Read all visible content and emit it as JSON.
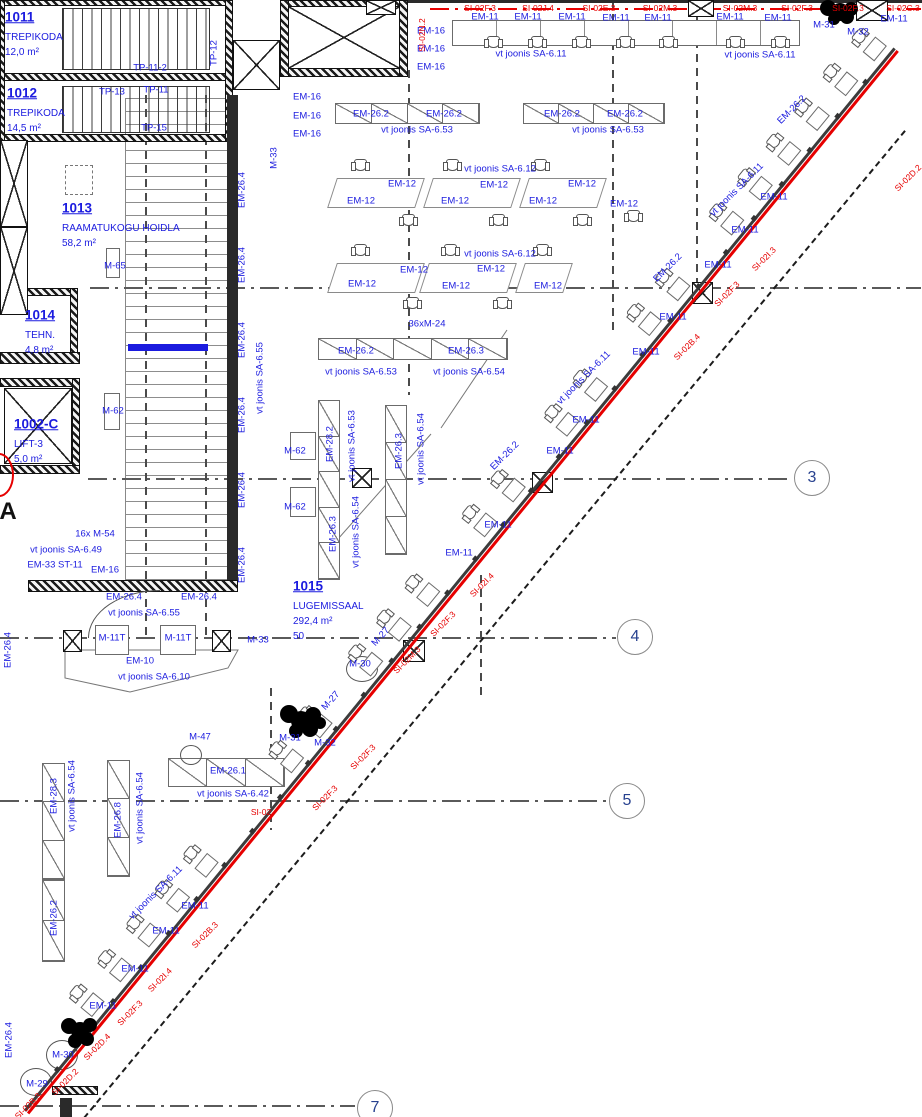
{
  "drawing": {
    "kind": "architectural-floor-plan",
    "language": "Estonian"
  },
  "colors": {
    "annotation_blue": "#1b1bdf",
    "marking_red": "#e60000",
    "grid_bubble_text": "#27418f"
  },
  "rooms": [
    {
      "id": "1011",
      "name": "TREPIKODA",
      "area": "12,0 m²",
      "x": 5,
      "y": 17
    },
    {
      "id": "1012",
      "name": "TREPIKODA",
      "area": "14,5 m²",
      "x": 7,
      "y": 93
    },
    {
      "id": "1013",
      "name": "RAAMATUKOGU HOIDLA",
      "area": "58,2 m²",
      "x": 62,
      "y": 208
    },
    {
      "id": "1014",
      "name": "TEHN.",
      "area": "4,8 m²",
      "x": 25,
      "y": 315
    },
    {
      "id": "1002-C",
      "name": "LIFT-3",
      "area": "5,0 m²",
      "x": 14,
      "y": 424
    },
    {
      "id": "1015",
      "name": "LUGEMISSAAL",
      "area": "292,4 m²",
      "extra": "50",
      "x": 293,
      "y": 586
    }
  ],
  "grid_bubbles": [
    {
      "n": "3",
      "x": 812,
      "y": 478
    },
    {
      "n": "4",
      "x": 635,
      "y": 637
    },
    {
      "n": "5",
      "x": 627,
      "y": 801
    },
    {
      "n": "7",
      "x": 375,
      "y": 1108
    }
  ],
  "grid_letters": [
    {
      "t": "A",
      "x": 8,
      "y": 512
    }
  ],
  "annotations": [
    {
      "t": "TP-11-2",
      "x": 150,
      "y": 68
    },
    {
      "t": "TP-13",
      "x": 112,
      "y": 92
    },
    {
      "t": "TP-11",
      "x": 156,
      "y": 90
    },
    {
      "t": "TP-15",
      "x": 154,
      "y": 128
    },
    {
      "t": "TP-12",
      "x": 214,
      "y": 53,
      "r": -90
    },
    {
      "t": "M-33",
      "x": 274,
      "y": 158,
      "r": -90
    },
    {
      "t": "EM-16",
      "x": 431,
      "y": 31
    },
    {
      "t": "EM-16",
      "x": 431,
      "y": 49
    },
    {
      "t": "EM-16",
      "x": 431,
      "y": 67
    },
    {
      "t": "EM-16",
      "x": 307,
      "y": 97
    },
    {
      "t": "EM-16",
      "x": 307,
      "y": 116
    },
    {
      "t": "EM-16",
      "x": 307,
      "y": 134
    },
    {
      "t": "EM-11",
      "x": 485,
      "y": 17
    },
    {
      "t": "EM-11",
      "x": 528,
      "y": 17
    },
    {
      "t": "EM-11",
      "x": 572,
      "y": 17
    },
    {
      "t": "EM-11",
      "x": 616,
      "y": 18
    },
    {
      "t": "EM-11",
      "x": 658,
      "y": 18
    },
    {
      "t": "EM-11",
      "x": 730,
      "y": 17
    },
    {
      "t": "EM-11",
      "x": 778,
      "y": 18
    },
    {
      "t": "EM-11",
      "x": 894,
      "y": 19
    },
    {
      "t": "vt joonis SA-6.11",
      "x": 531,
      "y": 54
    },
    {
      "t": "vt joonis SA-6.11",
      "x": 760,
      "y": 55
    },
    {
      "t": "M-31",
      "x": 824,
      "y": 25
    },
    {
      "t": "M-32",
      "x": 858,
      "y": 32
    },
    {
      "t": "EM-26.2",
      "x": 371,
      "y": 114
    },
    {
      "t": "EM-26.2",
      "x": 444,
      "y": 114
    },
    {
      "t": "EM-26.2",
      "x": 562,
      "y": 114
    },
    {
      "t": "EM-26.2",
      "x": 625,
      "y": 114
    },
    {
      "t": "vt joonis SA-6.53",
      "x": 417,
      "y": 130
    },
    {
      "t": "vt joonis SA-6.53",
      "x": 608,
      "y": 130
    },
    {
      "t": "vt joonis SA-6.12",
      "x": 500,
      "y": 169
    },
    {
      "t": "vt joonis SA-6.12",
      "x": 500,
      "y": 254
    },
    {
      "t": "EM-12",
      "x": 361,
      "y": 201
    },
    {
      "t": "EM-12",
      "x": 402,
      "y": 184
    },
    {
      "t": "EM-12",
      "x": 455,
      "y": 201
    },
    {
      "t": "EM-12",
      "x": 494,
      "y": 185
    },
    {
      "t": "EM-12",
      "x": 543,
      "y": 201
    },
    {
      "t": "EM-12",
      "x": 582,
      "y": 184
    },
    {
      "t": "EM-12",
      "x": 624,
      "y": 204
    },
    {
      "t": "EM-12",
      "x": 362,
      "y": 284
    },
    {
      "t": "EM-12",
      "x": 414,
      "y": 270
    },
    {
      "t": "EM-12",
      "x": 456,
      "y": 286
    },
    {
      "t": "EM-12",
      "x": 491,
      "y": 269
    },
    {
      "t": "EM-12",
      "x": 548,
      "y": 286
    },
    {
      "t": "36xM-24",
      "x": 427,
      "y": 324
    },
    {
      "t": "EM-26.2",
      "x": 356,
      "y": 351
    },
    {
      "t": "EM-26.3",
      "x": 466,
      "y": 351
    },
    {
      "t": "vt joonis SA-6.53",
      "x": 361,
      "y": 372
    },
    {
      "t": "vt joonis SA-6.54",
      "x": 469,
      "y": 372
    },
    {
      "t": "M-65",
      "x": 115,
      "y": 266
    },
    {
      "t": "M-62",
      "x": 113,
      "y": 411
    },
    {
      "t": "M-62",
      "x": 295,
      "y": 451
    },
    {
      "t": "M-62",
      "x": 295,
      "y": 507
    },
    {
      "t": "EM-28.2",
      "x": 330,
      "y": 444,
      "r": -90
    },
    {
      "t": "vt joonis SA-6.53",
      "x": 352,
      "y": 446,
      "r": -90
    },
    {
      "t": "EM-26.3",
      "x": 333,
      "y": 534,
      "r": -90
    },
    {
      "t": "vt joonis SA-6.54",
      "x": 356,
      "y": 532,
      "r": -90
    },
    {
      "t": "EM-26.3",
      "x": 399,
      "y": 451,
      "r": -90
    },
    {
      "t": "vt joonis SA-6.54",
      "x": 421,
      "y": 449,
      "r": -90
    },
    {
      "t": "EM-26.4",
      "x": 242,
      "y": 190,
      "r": -90
    },
    {
      "t": "EM-26.4",
      "x": 242,
      "y": 265,
      "r": -90
    },
    {
      "t": "EM-26.4",
      "x": 242,
      "y": 340,
      "r": -90
    },
    {
      "t": "EM-26.4",
      "x": 242,
      "y": 415,
      "r": -90
    },
    {
      "t": "EM-26.4",
      "x": 242,
      "y": 490,
      "r": -90
    },
    {
      "t": "EM-26.4",
      "x": 242,
      "y": 565,
      "r": -90
    },
    {
      "t": "vt joonis SA-6.55",
      "x": 260,
      "y": 378,
      "r": -90
    },
    {
      "t": "16x M-54",
      "x": 95,
      "y": 534
    },
    {
      "t": "vt joonis SA-6.49",
      "x": 66,
      "y": 550
    },
    {
      "t": "EM-33 ST-11",
      "x": 55,
      "y": 565
    },
    {
      "t": "EM-16",
      "x": 105,
      "y": 570
    },
    {
      "t": "EM-26.4",
      "x": 124,
      "y": 597
    },
    {
      "t": "EM-26.4",
      "x": 199,
      "y": 597
    },
    {
      "t": "vt joonis SA-6.55",
      "x": 144,
      "y": 613
    },
    {
      "t": "M-11T",
      "x": 112,
      "y": 638
    },
    {
      "t": "M-11T",
      "x": 178,
      "y": 638
    },
    {
      "t": "M-33",
      "x": 258,
      "y": 640
    },
    {
      "t": "EM-10",
      "x": 140,
      "y": 661
    },
    {
      "t": "vt joonis SA-6.10",
      "x": 154,
      "y": 677
    },
    {
      "t": "M-27",
      "x": 381,
      "y": 637,
      "r": -48
    },
    {
      "t": "M-27",
      "x": 331,
      "y": 701,
      "r": -48
    },
    {
      "t": "M-30",
      "x": 360,
      "y": 664
    },
    {
      "t": "M-47",
      "x": 200,
      "y": 737
    },
    {
      "t": "M-31",
      "x": 290,
      "y": 738
    },
    {
      "t": "M-32",
      "x": 325,
      "y": 743
    },
    {
      "t": "EM-26.1",
      "x": 228,
      "y": 771
    },
    {
      "t": "vt joonis SA-6.42",
      "x": 233,
      "y": 794
    },
    {
      "t": "EM-11",
      "x": 774,
      "y": 197
    },
    {
      "t": "EM-11",
      "x": 745,
      "y": 230
    },
    {
      "t": "EM-11",
      "x": 718,
      "y": 265
    },
    {
      "t": "EM-11",
      "x": 673,
      "y": 317
    },
    {
      "t": "EM-11",
      "x": 646,
      "y": 352
    },
    {
      "t": "EM-11",
      "x": 586,
      "y": 420
    },
    {
      "t": "EM-11",
      "x": 560,
      "y": 451
    },
    {
      "t": "EM-11",
      "x": 498,
      "y": 525
    },
    {
      "t": "EM-11",
      "x": 459,
      "y": 553
    },
    {
      "t": "EM-26.2",
      "x": 792,
      "y": 110,
      "r": -45
    },
    {
      "t": "EM-26.2",
      "x": 668,
      "y": 268,
      "r": -45
    },
    {
      "t": "EM-26.2",
      "x": 505,
      "y": 456,
      "r": -45
    },
    {
      "t": "vt joonis SA-6.11",
      "x": 737,
      "y": 190,
      "r": -45
    },
    {
      "t": "vt joonis SA-6.11",
      "x": 584,
      "y": 378,
      "r": -45
    },
    {
      "t": "vt joonis SA-6.11",
      "x": 156,
      "y": 893,
      "r": -45
    },
    {
      "t": "EM-11",
      "x": 195,
      "y": 906
    },
    {
      "t": "EM-11",
      "x": 166,
      "y": 931
    },
    {
      "t": "EM-11",
      "x": 135,
      "y": 969
    },
    {
      "t": "EM-11",
      "x": 103,
      "y": 1006
    },
    {
      "t": "M-30",
      "x": 63,
      "y": 1055
    },
    {
      "t": "M-29",
      "x": 37,
      "y": 1084
    },
    {
      "t": "EM-28.3",
      "x": 54,
      "y": 796,
      "r": -90
    },
    {
      "t": "vt joonis SA-6.54",
      "x": 72,
      "y": 796,
      "r": -90
    },
    {
      "t": "EM-26.8",
      "x": 118,
      "y": 820,
      "r": -90
    },
    {
      "t": "vt joonis SA-6.54",
      "x": 140,
      "y": 808,
      "r": -90
    },
    {
      "t": "EM-26.2",
      "x": 54,
      "y": 918,
      "r": -90
    },
    {
      "t": "EM-26.4",
      "x": 8,
      "y": 650,
      "r": -90
    },
    {
      "t": "EM-26.4",
      "x": 9,
      "y": 1040,
      "r": -90
    }
  ],
  "red_labels": [
    {
      "t": "SI-02N.2",
      "x": 422,
      "y": 35,
      "r": -90
    },
    {
      "t": "SI-02F.3",
      "x": 480,
      "y": 8
    },
    {
      "t": "SI-02J.4",
      "x": 538,
      "y": 8
    },
    {
      "t": "SI-02E.3",
      "x": 599,
      "y": 8
    },
    {
      "t": "SI-02M.3",
      "x": 660,
      "y": 8
    },
    {
      "t": "SI-02M.3",
      "x": 740,
      "y": 8
    },
    {
      "t": "SI-02F.3",
      "x": 797,
      "y": 8
    },
    {
      "t": "SI-02F.3",
      "x": 848,
      "y": 8
    },
    {
      "t": "SI-02C.3",
      "x": 903,
      "y": 8
    },
    {
      "t": "SI-02",
      "x": 261,
      "y": 812
    },
    {
      "t": "SI-02D.2",
      "x": 908,
      "y": 178,
      "r": -45
    },
    {
      "t": "SI-02I.3",
      "x": 764,
      "y": 259,
      "r": -45
    },
    {
      "t": "SI-02F.3",
      "x": 727,
      "y": 294,
      "r": -45
    },
    {
      "t": "SI-02B.4",
      "x": 687,
      "y": 347,
      "r": -45
    },
    {
      "t": "SI-02I.4",
      "x": 482,
      "y": 585,
      "r": -45
    },
    {
      "t": "SI-02F.3",
      "x": 443,
      "y": 624,
      "r": -45
    },
    {
      "t": "SI-02M.3",
      "x": 407,
      "y": 660,
      "r": -45
    },
    {
      "t": "SI-02F.3",
      "x": 363,
      "y": 757,
      "r": -45
    },
    {
      "t": "SI-02F.3",
      "x": 325,
      "y": 798,
      "r": -45
    },
    {
      "t": "SI-02B.3",
      "x": 205,
      "y": 935,
      "r": -45
    },
    {
      "t": "SI-02I.4",
      "x": 160,
      "y": 980,
      "r": -45
    },
    {
      "t": "SI-02F.3",
      "x": 130,
      "y": 1013,
      "r": -45
    },
    {
      "t": "SI-02D.4",
      "x": 97,
      "y": 1047,
      "r": -45
    },
    {
      "t": "SI-02D.2",
      "x": 65,
      "y": 1082,
      "r": -45
    },
    {
      "t": "SI-02B.3",
      "x": 28,
      "y": 1106,
      "r": -45
    }
  ],
  "walls": [
    [
      0,
      0,
      233,
      6,
      "h"
    ],
    [
      0,
      73,
      233,
      8,
      "h"
    ],
    [
      0,
      134,
      233,
      8,
      "h"
    ],
    [
      225,
      0,
      8,
      142,
      "h"
    ],
    [
      0,
      0,
      5,
      142,
      "h"
    ],
    [
      280,
      0,
      128,
      7,
      "h"
    ],
    [
      280,
      68,
      128,
      9,
      "h"
    ],
    [
      280,
      0,
      9,
      77,
      "h"
    ],
    [
      399,
      0,
      9,
      77,
      "h"
    ],
    [
      408,
      0,
      514,
      3,
      "s"
    ],
    [
      0,
      288,
      78,
      8,
      "h"
    ],
    [
      70,
      288,
      8,
      72,
      "h"
    ],
    [
      0,
      352,
      80,
      12,
      "h"
    ],
    [
      0,
      378,
      80,
      9,
      "h"
    ],
    [
      72,
      378,
      8,
      96,
      "h"
    ],
    [
      0,
      465,
      80,
      9,
      "h"
    ],
    [
      227,
      95,
      11,
      488,
      "s"
    ],
    [
      28,
      580,
      210,
      12,
      "h"
    ],
    [
      128,
      344,
      80,
      7,
      "b"
    ],
    [
      52,
      1086,
      46,
      9,
      "h"
    ],
    [
      60,
      1098,
      12,
      19,
      "s"
    ]
  ],
  "xboxes": [
    [
      288,
      6,
      112,
      63
    ],
    [
      233,
      40,
      47,
      50
    ],
    [
      0,
      140,
      28,
      87
    ],
    [
      0,
      227,
      28,
      88
    ],
    [
      4,
      388,
      68,
      76
    ],
    [
      352,
      468,
      20,
      20
    ],
    [
      63,
      630,
      19,
      22
    ],
    [
      212,
      630,
      19,
      22
    ],
    [
      692,
      282,
      21,
      22
    ],
    [
      532,
      472,
      21,
      21
    ],
    [
      403,
      640,
      22,
      22
    ],
    [
      366,
      0,
      30,
      15
    ],
    [
      688,
      0,
      26,
      17
    ],
    [
      856,
      0,
      32,
      21
    ]
  ],
  "strips": [
    [
      335,
      103,
      145,
      21,
      4,
      "h"
    ],
    [
      523,
      103,
      142,
      21,
      4,
      "h"
    ],
    [
      318,
      338,
      190,
      22,
      5,
      "h"
    ],
    [
      168,
      758,
      117,
      29,
      3,
      "h"
    ],
    [
      318,
      400,
      22,
      180,
      5,
      "v"
    ],
    [
      385,
      405,
      22,
      150,
      4,
      "v"
    ],
    [
      42,
      763,
      23,
      117,
      3,
      "v"
    ],
    [
      107,
      760,
      23,
      117,
      3,
      "v"
    ],
    [
      42,
      880,
      23,
      82,
      2,
      "v"
    ]
  ],
  "boxes": [
    [
      106,
      248,
      14,
      30
    ],
    [
      104,
      393,
      16,
      37
    ],
    [
      290,
      432,
      26,
      28
    ],
    [
      290,
      487,
      26,
      30
    ],
    [
      95,
      625,
      34,
      30
    ],
    [
      160,
      625,
      36,
      30
    ]
  ],
  "dash_boxes": [
    [
      65,
      165,
      28,
      30
    ]
  ],
  "desk_band": [
    452,
    20,
    348,
    26
  ],
  "tables": [
    [
      332,
      178,
      88,
      30
    ],
    [
      428,
      178,
      88,
      30
    ],
    [
      524,
      178,
      78,
      30
    ],
    [
      332,
      263,
      88,
      30
    ],
    [
      424,
      263,
      88,
      30
    ],
    [
      520,
      263,
      48,
      30
    ]
  ],
  "chairs": [
    [
      493,
      42
    ],
    [
      537,
      42
    ],
    [
      581,
      42
    ],
    [
      625,
      42
    ],
    [
      668,
      42
    ],
    [
      735,
      42
    ],
    [
      780,
      42
    ],
    [
      360,
      165
    ],
    [
      452,
      165
    ],
    [
      540,
      165
    ],
    [
      408,
      220
    ],
    [
      498,
      220
    ],
    [
      582,
      220
    ],
    [
      633,
      216
    ],
    [
      360,
      250
    ],
    [
      450,
      250
    ],
    [
      542,
      250
    ],
    [
      412,
      303
    ],
    [
      502,
      303
    ]
  ],
  "circles": [
    [
      180,
      745,
      22,
      20
    ],
    [
      346,
      656,
      32,
      26
    ],
    [
      46,
      1040,
      32,
      30
    ],
    [
      20,
      1068,
      32,
      28
    ]
  ],
  "shelf": [
    125,
    98,
    105,
    482
  ],
  "stairs": [
    [
      62,
      8,
      148,
      62
    ],
    [
      62,
      86,
      148,
      47
    ]
  ],
  "gridlines_h": [
    [
      90,
      287,
      921,
      "g"
    ],
    [
      88,
      478,
      793,
      "g"
    ],
    [
      0,
      637,
      616,
      "g"
    ],
    [
      0,
      800,
      608,
      "g"
    ],
    [
      0,
      1105,
      355,
      "g"
    ],
    [
      430,
      8,
      921,
      "r"
    ]
  ],
  "gridlines_v": [
    [
      145,
      95,
      640
    ],
    [
      205,
      95,
      640
    ],
    [
      408,
      70,
      395
    ],
    [
      612,
      0,
      330
    ],
    [
      696,
      12,
      290
    ],
    [
      270,
      688,
      830
    ],
    [
      480,
      575,
      700
    ]
  ],
  "facade": {
    "x": 30,
    "y": 1115,
    "len": 1373,
    "angle": -50.7,
    "mullion_step": 44,
    "desks": [
      115,
      160,
      205,
      250,
      295,
      430,
      475,
      555,
      600,
      645,
      735,
      780,
      865,
      910,
      995,
      1040,
      1125,
      1170,
      1215,
      1260,
      1305,
      1350
    ]
  },
  "dash_diag": {
    "x": 84,
    "y": 1117,
    "len": 1284,
    "angle": -50.25
  },
  "scribbles": [
    [
      828,
      8,
      8
    ],
    [
      840,
      12,
      9
    ],
    [
      851,
      9,
      7
    ],
    [
      834,
      19,
      6
    ],
    [
      847,
      17,
      7
    ],
    [
      289,
      714,
      9
    ],
    [
      301,
      721,
      10
    ],
    [
      313,
      715,
      8
    ],
    [
      296,
      731,
      7
    ],
    [
      310,
      729,
      8
    ],
    [
      320,
      723,
      6
    ],
    [
      69,
      1026,
      8
    ],
    [
      80,
      1031,
      9
    ],
    [
      90,
      1025,
      7
    ],
    [
      75,
      1041,
      7
    ],
    [
      87,
      1039,
      7
    ]
  ],
  "svg_polys": [
    {
      "points": "65,650 238,650 228,668 130,692 65,678"
    }
  ],
  "svg_lines": [
    [
      441,
      428,
      507,
      330
    ],
    [
      322,
      557,
      431,
      434
    ]
  ],
  "door_arc": [
    88,
    590,
    72,
    48
  ],
  "red_arc": [
    -16,
    453,
    30,
    44
  ]
}
